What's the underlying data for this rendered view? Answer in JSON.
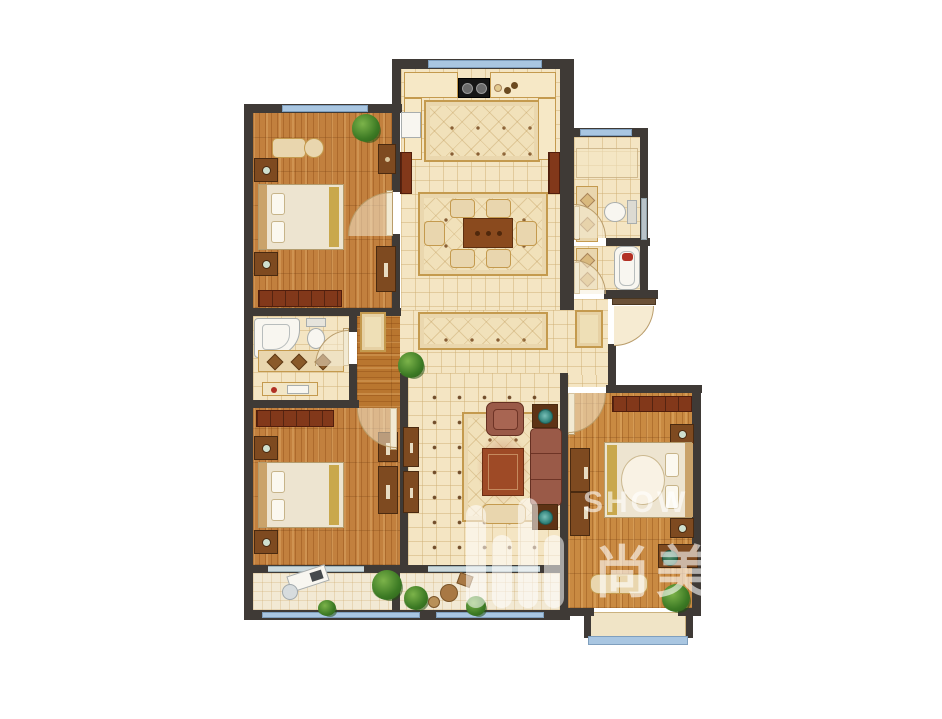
{
  "watermark": {
    "brand": "SHOW",
    "characters": "尚美",
    "logo_icon": "equalizer-bars-logo"
  },
  "palette": {
    "background": "#ffffff",
    "wall": "#3f3a36",
    "tile_floor": "#f4e5c3",
    "tile_line": "#dfc69a",
    "wood_floor": "#c2803e",
    "wood_floor_right_bedroom": "#c98a42",
    "balcony_floor": "#f2e9d4",
    "window_glass": "#a9c6e1",
    "window_frame": "#7f9fbe",
    "closet_wood": "#82381a",
    "cabinet_wood": "#7e4a20",
    "sofa": "#9a5a48",
    "coffee_table": "#9e4a26",
    "rug": "#f1e1ba",
    "rug_border": "#c49a4e",
    "plant_green": "#3c7a24",
    "fixture_white": "#f8f6f0",
    "accent_red": "#b03024",
    "watermark_white": "rgba(255,255,255,0.55)"
  },
  "rooms": [
    {
      "name": "bedroom-top-left",
      "floor": "wood"
    },
    {
      "name": "kitchen",
      "floor": "tile"
    },
    {
      "name": "dining-area",
      "floor": "tile"
    },
    {
      "name": "hallway",
      "floor": "tile"
    },
    {
      "name": "inner-corridor",
      "floor": "wood"
    },
    {
      "name": "bathroom-upper-right",
      "floor": "tile"
    },
    {
      "name": "bathroom-lower-right",
      "floor": "tile"
    },
    {
      "name": "entry-vestibule",
      "floor": "tile"
    },
    {
      "name": "bathroom-left",
      "floor": "tile"
    },
    {
      "name": "bedroom-bottom-left",
      "floor": "wood"
    },
    {
      "name": "living-room",
      "floor": "tile"
    },
    {
      "name": "bedroom-bottom-right",
      "floor": "wood"
    },
    {
      "name": "balcony",
      "floor": "tile"
    },
    {
      "name": "bay-window",
      "floor": "sill"
    }
  ],
  "furniture_icons": [
    "double-bed",
    "nightstand",
    "wardrobe-closet",
    "dresser",
    "chaise-bench",
    "potted-plant",
    "cooktop",
    "fridge",
    "kitchen-counter",
    "area-rug",
    "dining-table",
    "dining-chair",
    "runner-rug",
    "door-mat",
    "vanity-sink",
    "toilet",
    "bathtub",
    "corner-bathtub",
    "sofa",
    "armchair",
    "coffee-table",
    "side-table",
    "tv-cabinet",
    "ottoman",
    "desk",
    "desk-chair",
    "bench",
    "swing-door",
    "window",
    "bay-window",
    "wicker-chair"
  ]
}
